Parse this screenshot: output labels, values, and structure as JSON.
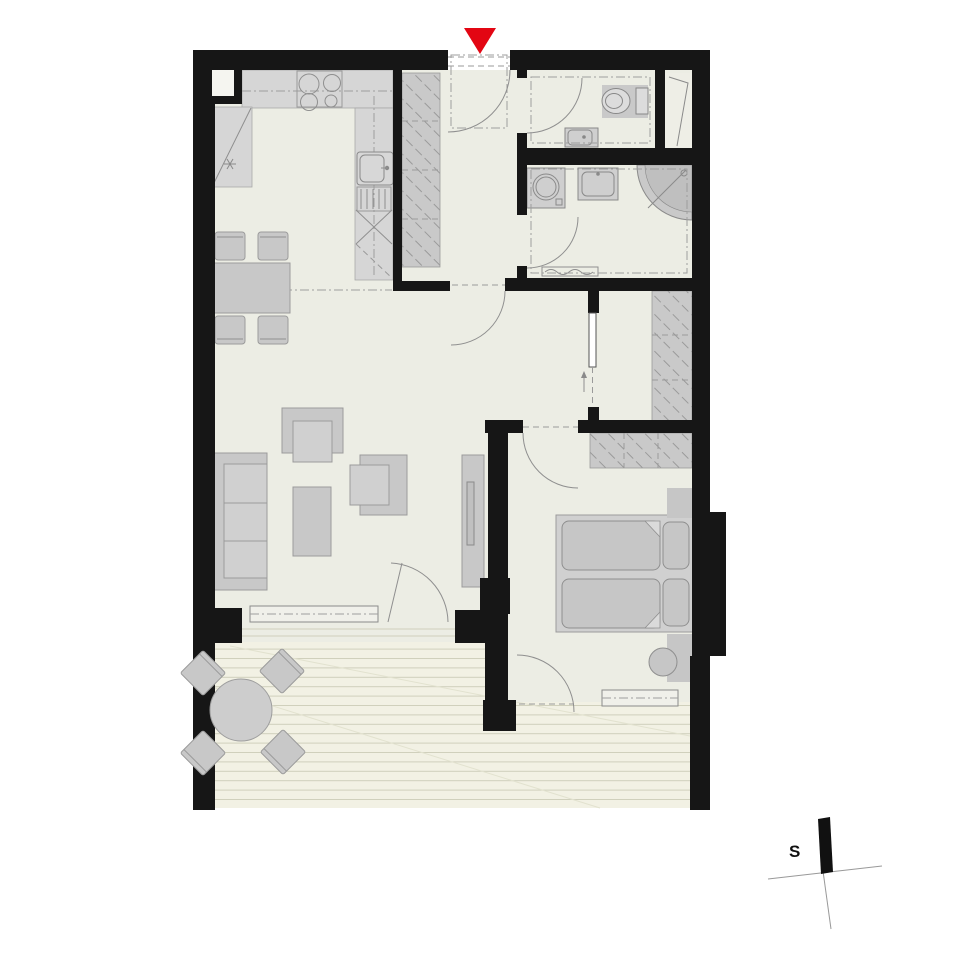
{
  "document": {
    "type": "apartment-floor-plan",
    "title": ""
  },
  "compass": {
    "label": "S"
  },
  "entrance": {
    "marker": "red-triangle-down",
    "marker_color": "#e30613"
  },
  "colors": {
    "background": "#ffffff",
    "wall": "#161616",
    "floor": "#ecede4",
    "deck": "#f2f1e4",
    "deck_line": "#cfcfbc",
    "furniture_fill": "#c8c8c8",
    "furniture_stroke": "#9b9b9b",
    "entrance_marker": "#e30613"
  },
  "rooms": [
    {
      "name": "kitchen-dining",
      "fixtures": [
        "l-shaped-counter",
        "stove-4-burners",
        "corner-cabinet",
        "fridge-freezer",
        "sink",
        "dishwasher",
        "dining-table",
        "dining-chairs-x4"
      ]
    },
    {
      "name": "entry-hall",
      "fixtures": [
        "entrance-door",
        "built-in-wardrobe"
      ]
    },
    {
      "name": "wc",
      "fixtures": [
        "toilet",
        "washbasin",
        "door"
      ]
    },
    {
      "name": "bathroom",
      "fixtures": [
        "washing-machine",
        "washbasin",
        "corner-shower",
        "radiator",
        "door"
      ]
    },
    {
      "name": "corridor",
      "fixtures": [
        "sliding-door",
        "built-in-wardrobe"
      ]
    },
    {
      "name": "bedroom",
      "fixtures": [
        "double-bed",
        "pillows-x2",
        "nightstands-x2",
        "stool",
        "built-in-wardrobe",
        "window",
        "terrace-door"
      ]
    },
    {
      "name": "living-room",
      "fixtures": [
        "sofa",
        "armchairs-x2",
        "coffee-table",
        "tv-sideboard",
        "window",
        "terrace-door"
      ]
    },
    {
      "name": "terrace",
      "fixtures": [
        "wood-decking",
        "round-table",
        "chairs-x4"
      ]
    }
  ]
}
